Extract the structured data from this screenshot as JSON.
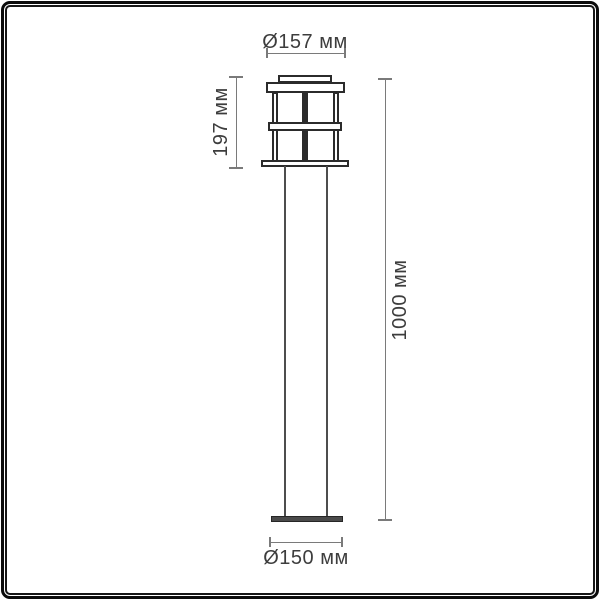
{
  "diagram": {
    "type": "technical-drawing",
    "subject": "outdoor-bollard-lantern",
    "labels": {
      "top_diameter": "Ø157 мм",
      "head_height": "197 мм",
      "total_height": "1000 мм",
      "base_diameter": "Ø150 мм"
    },
    "colors": {
      "outline": "#2b2b2b",
      "pole_line": "#4d4d4d",
      "dimension_line": "#7a7a7a",
      "text": "#3d3d3d",
      "frame": "#0b0b0b",
      "background": "#ffffff"
    }
  }
}
